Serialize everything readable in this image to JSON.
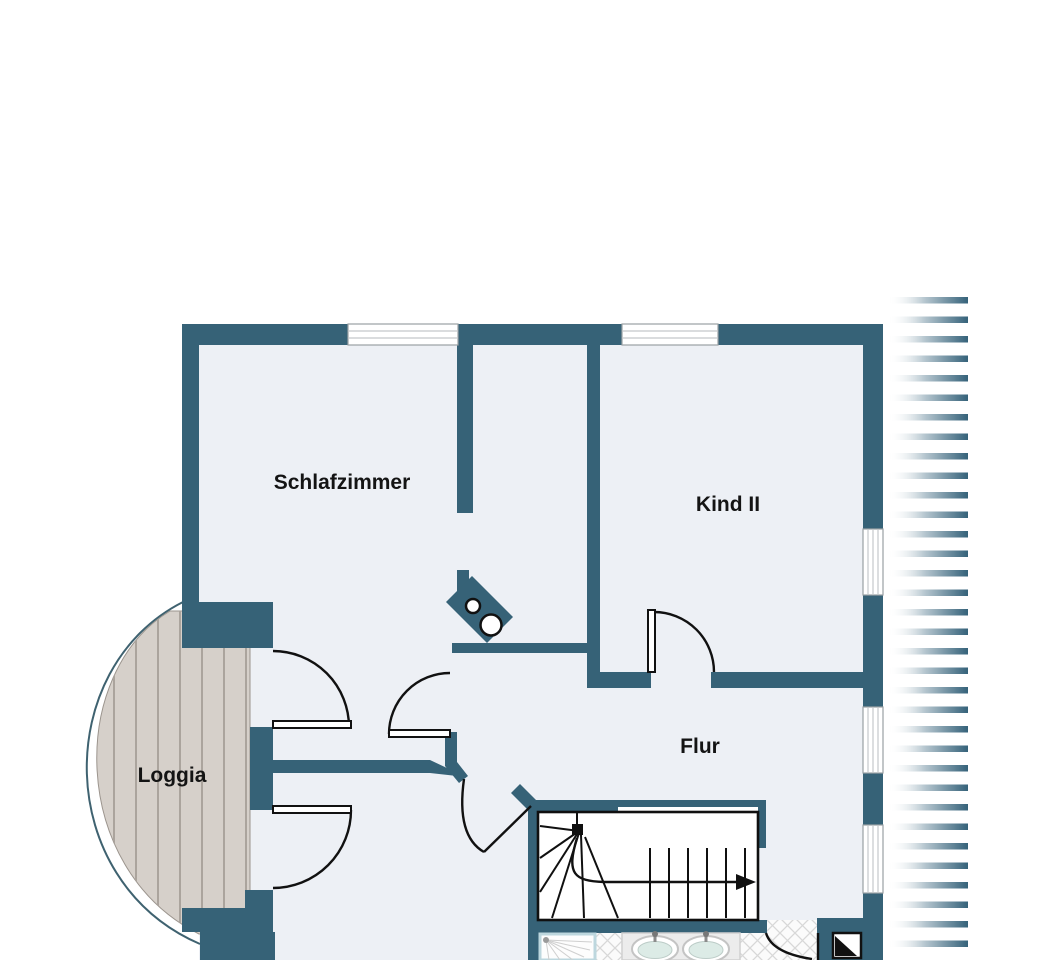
{
  "rooms": [
    {
      "id": "schlafzimmer",
      "label": "Schlafzimmer"
    },
    {
      "id": "kind-2",
      "label": "Kind II"
    },
    {
      "id": "flur",
      "label": "Flur"
    },
    {
      "id": "loggia",
      "label": "Loggia"
    }
  ],
  "colors": {
    "wall": "#366277",
    "floor": "#edf0f5",
    "wood": "#d6d0ca",
    "woodLine": "#aba49d",
    "woodEdge": "#9b948d",
    "outline": "#3f6270",
    "door": "#111111",
    "windowFrame": "#9aa0a4",
    "windowPane": "#c4c8cb",
    "tileLine": "#d8d8d8",
    "counter": "#ececec",
    "counterEdge": "#d0d0d0",
    "basin": "#dcebe6",
    "showerFrame": "#bdd7de",
    "hatch": "#35627a"
  },
  "symbols": {
    "stairs": "winder-staircase-with-up-arrow",
    "chimney": "chimney-with-two-round-flues",
    "washbasins": "double-washbasin-counter",
    "shower": "corner-shower",
    "marker": "black-white-triangle-entrance-marker",
    "roof": "roof-overhang-hatching"
  }
}
